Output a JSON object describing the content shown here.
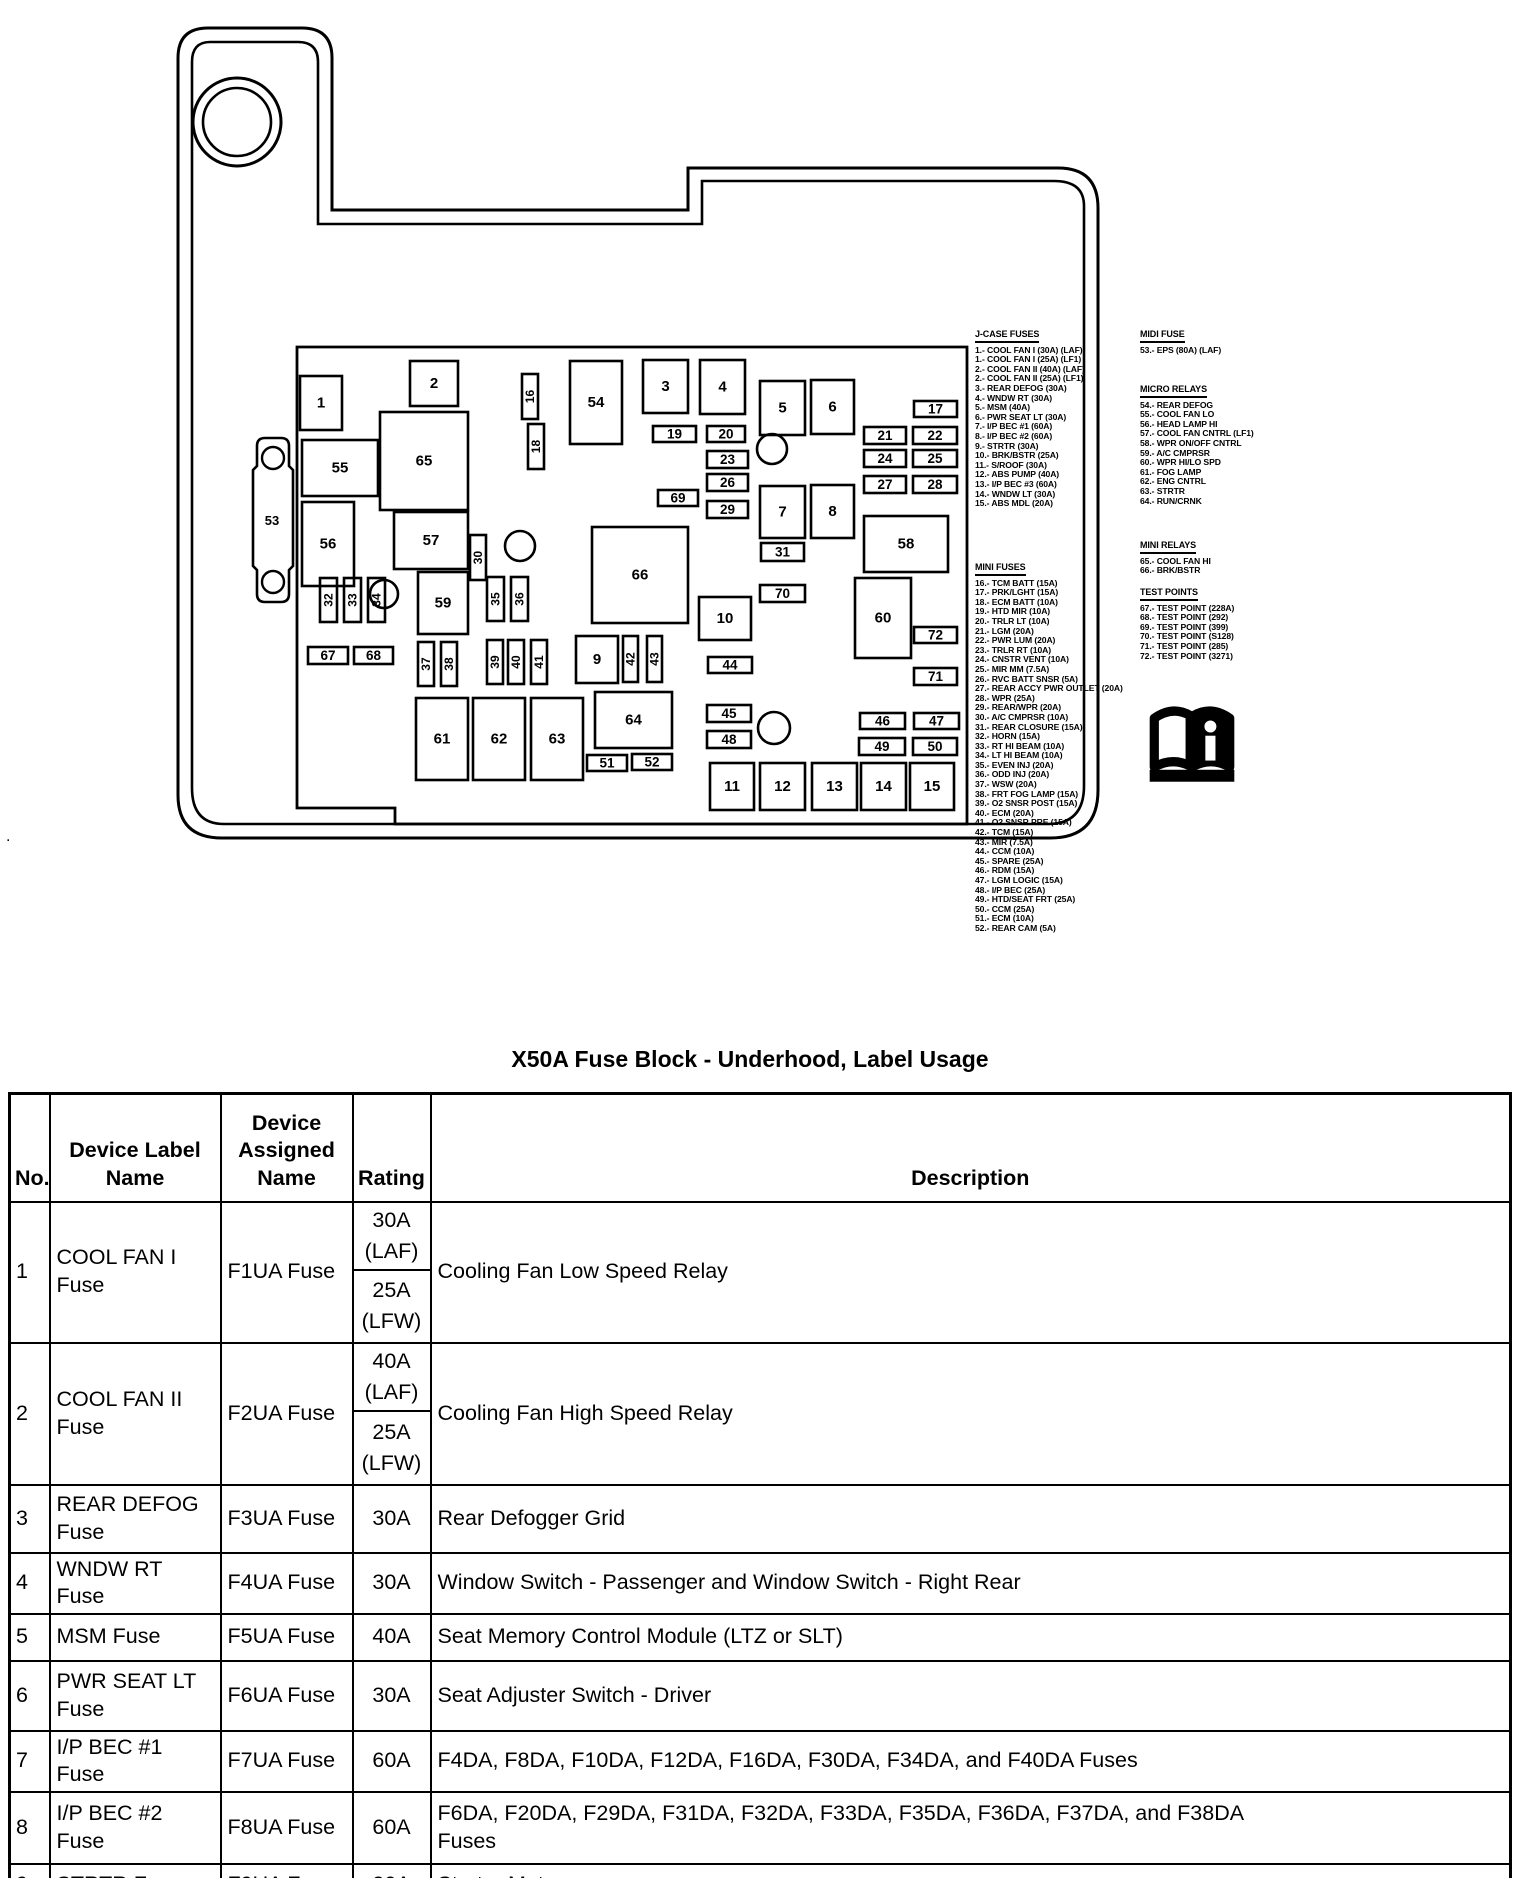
{
  "page": {
    "title": "X50A Fuse Block - Underhood, Label Usage",
    "stray_mark": "."
  },
  "diagram": {
    "bracket": {
      "label": "53",
      "holes": [
        {
          "cx": 273,
          "cy": 458,
          "r": 11
        },
        {
          "cx": 273,
          "cy": 582,
          "r": 11
        }
      ]
    },
    "donut": {
      "cx": 237,
      "cy": 122,
      "r_outer": 44,
      "r_inner": 34
    },
    "circles": [
      {
        "cx": 772,
        "cy": 449,
        "r": 15
      },
      {
        "cx": 520,
        "cy": 546,
        "r": 15
      },
      {
        "cx": 384,
        "cy": 594,
        "r": 14
      },
      {
        "cx": 774,
        "cy": 728,
        "r": 16
      }
    ],
    "boxes": [
      {
        "n": "1",
        "x": 300,
        "y": 376,
        "w": 42,
        "h": 54
      },
      {
        "n": "55",
        "x": 302,
        "y": 440,
        "w": 76,
        "h": 56
      },
      {
        "n": "56",
        "x": 302,
        "y": 502,
        "w": 52,
        "h": 84
      },
      {
        "n": "2",
        "x": 410,
        "y": 361,
        "w": 48,
        "h": 45
      },
      {
        "n": "65",
        "x": 380,
        "y": 412,
        "w": 88,
        "h": 98
      },
      {
        "n": "57",
        "x": 394,
        "y": 512,
        "w": 74,
        "h": 57
      },
      {
        "n": "59",
        "x": 418,
        "y": 572,
        "w": 50,
        "h": 62
      },
      {
        "n": "54",
        "x": 570,
        "y": 361,
        "w": 52,
        "h": 83
      },
      {
        "n": "3",
        "x": 643,
        "y": 360,
        "w": 45,
        "h": 53
      },
      {
        "n": "4",
        "x": 700,
        "y": 360,
        "w": 45,
        "h": 54
      },
      {
        "n": "5",
        "x": 760,
        "y": 381,
        "w": 45,
        "h": 54
      },
      {
        "n": "6",
        "x": 811,
        "y": 380,
        "w": 43,
        "h": 54
      },
      {
        "n": "7",
        "x": 760,
        "y": 486,
        "w": 45,
        "h": 52
      },
      {
        "n": "8",
        "x": 811,
        "y": 485,
        "w": 43,
        "h": 53
      },
      {
        "n": "58",
        "x": 864,
        "y": 516,
        "w": 84,
        "h": 56
      },
      {
        "n": "66",
        "x": 592,
        "y": 527,
        "w": 96,
        "h": 96
      },
      {
        "n": "60",
        "x": 855,
        "y": 578,
        "w": 56,
        "h": 80
      },
      {
        "n": "10",
        "x": 699,
        "y": 597,
        "w": 52,
        "h": 43
      },
      {
        "n": "9",
        "x": 576,
        "y": 636,
        "w": 42,
        "h": 47
      },
      {
        "n": "61",
        "x": 416,
        "y": 698,
        "w": 52,
        "h": 82
      },
      {
        "n": "62",
        "x": 473,
        "y": 698,
        "w": 52,
        "h": 82
      },
      {
        "n": "63",
        "x": 531,
        "y": 698,
        "w": 52,
        "h": 82
      },
      {
        "n": "64",
        "x": 595,
        "y": 692,
        "w": 77,
        "h": 56
      },
      {
        "n": "11",
        "x": 710,
        "y": 763,
        "w": 44,
        "h": 47
      },
      {
        "n": "12",
        "x": 760,
        "y": 763,
        "w": 45,
        "h": 47
      },
      {
        "n": "13",
        "x": 812,
        "y": 763,
        "w": 45,
        "h": 47
      },
      {
        "n": "14",
        "x": 861,
        "y": 763,
        "w": 45,
        "h": 47
      },
      {
        "n": "15",
        "x": 910,
        "y": 763,
        "w": 44,
        "h": 47
      },
      {
        "n": "17",
        "x": 914,
        "y": 401,
        "w": 43,
        "h": 16,
        "s": 1
      },
      {
        "n": "19",
        "x": 653,
        "y": 426,
        "w": 43,
        "h": 16,
        "s": 1
      },
      {
        "n": "20",
        "x": 707,
        "y": 426,
        "w": 38,
        "h": 16,
        "s": 1
      },
      {
        "n": "23",
        "x": 707,
        "y": 451,
        "w": 41,
        "h": 17,
        "s": 1
      },
      {
        "n": "26",
        "x": 707,
        "y": 474,
        "w": 41,
        "h": 17,
        "s": 1
      },
      {
        "n": "69",
        "x": 658,
        "y": 490,
        "w": 40,
        "h": 16,
        "s": 1
      },
      {
        "n": "29",
        "x": 707,
        "y": 501,
        "w": 41,
        "h": 17,
        "s": 1
      },
      {
        "n": "21",
        "x": 864,
        "y": 427,
        "w": 42,
        "h": 17,
        "s": 1
      },
      {
        "n": "22",
        "x": 913,
        "y": 427,
        "w": 44,
        "h": 17,
        "s": 1
      },
      {
        "n": "24",
        "x": 864,
        "y": 450,
        "w": 42,
        "h": 17,
        "s": 1
      },
      {
        "n": "25",
        "x": 913,
        "y": 450,
        "w": 44,
        "h": 17,
        "s": 1
      },
      {
        "n": "27",
        "x": 864,
        "y": 476,
        "w": 42,
        "h": 17,
        "s": 1
      },
      {
        "n": "28",
        "x": 913,
        "y": 476,
        "w": 44,
        "h": 17,
        "s": 1
      },
      {
        "n": "31",
        "x": 761,
        "y": 543,
        "w": 43,
        "h": 18,
        "s": 1
      },
      {
        "n": "70",
        "x": 760,
        "y": 585,
        "w": 45,
        "h": 17,
        "s": 1
      },
      {
        "n": "72",
        "x": 914,
        "y": 627,
        "w": 43,
        "h": 16,
        "s": 1
      },
      {
        "n": "71",
        "x": 914,
        "y": 668,
        "w": 43,
        "h": 17,
        "s": 1
      },
      {
        "n": "44",
        "x": 708,
        "y": 657,
        "w": 44,
        "h": 16,
        "s": 1
      },
      {
        "n": "45",
        "x": 707,
        "y": 705,
        "w": 44,
        "h": 17,
        "s": 1
      },
      {
        "n": "48",
        "x": 707,
        "y": 731,
        "w": 44,
        "h": 17,
        "s": 1
      },
      {
        "n": "46",
        "x": 860,
        "y": 713,
        "w": 45,
        "h": 16,
        "s": 1
      },
      {
        "n": "47",
        "x": 914,
        "y": 713,
        "w": 45,
        "h": 16,
        "s": 1
      },
      {
        "n": "49",
        "x": 859,
        "y": 738,
        "w": 46,
        "h": 17,
        "s": 1
      },
      {
        "n": "50",
        "x": 913,
        "y": 738,
        "w": 44,
        "h": 17,
        "s": 1
      },
      {
        "n": "51",
        "x": 587,
        "y": 755,
        "w": 40,
        "h": 16,
        "s": 1
      },
      {
        "n": "52",
        "x": 632,
        "y": 754,
        "w": 40,
        "h": 16,
        "s": 1
      },
      {
        "n": "67",
        "x": 308,
        "y": 647,
        "w": 40,
        "h": 17,
        "s": 1
      },
      {
        "n": "68",
        "x": 354,
        "y": 647,
        "w": 39,
        "h": 17,
        "s": 1
      },
      {
        "n": "16",
        "x": 522,
        "y": 374,
        "w": 16,
        "h": 45,
        "v": 1
      },
      {
        "n": "18",
        "x": 528,
        "y": 424,
        "w": 16,
        "h": 45,
        "v": 1
      },
      {
        "n": "30",
        "x": 470,
        "y": 535,
        "w": 16,
        "h": 45,
        "v": 1
      },
      {
        "n": "32",
        "x": 320,
        "y": 578,
        "w": 17,
        "h": 44,
        "v": 1
      },
      {
        "n": "33",
        "x": 344,
        "y": 578,
        "w": 17,
        "h": 44,
        "v": 1
      },
      {
        "n": "34",
        "x": 368,
        "y": 578,
        "w": 17,
        "h": 44,
        "v": 1
      },
      {
        "n": "35",
        "x": 487,
        "y": 577,
        "w": 17,
        "h": 44,
        "v": 1
      },
      {
        "n": "36",
        "x": 511,
        "y": 577,
        "w": 17,
        "h": 44,
        "v": 1
      },
      {
        "n": "37",
        "x": 418,
        "y": 642,
        "w": 16,
        "h": 44,
        "v": 1
      },
      {
        "n": "38",
        "x": 441,
        "y": 642,
        "w": 16,
        "h": 44,
        "v": 1
      },
      {
        "n": "39",
        "x": 487,
        "y": 640,
        "w": 16,
        "h": 44,
        "v": 1
      },
      {
        "n": "40",
        "x": 508,
        "y": 640,
        "w": 16,
        "h": 44,
        "v": 1
      },
      {
        "n": "41",
        "x": 531,
        "y": 640,
        "w": 16,
        "h": 44,
        "v": 1
      },
      {
        "n": "42",
        "x": 623,
        "y": 636,
        "w": 15,
        "h": 46,
        "v": 1
      },
      {
        "n": "43",
        "x": 647,
        "y": 636,
        "w": 15,
        "h": 46,
        "v": 1
      }
    ],
    "legend": {
      "col1": [
        {
          "header": "J-CASE FUSES",
          "top": 330,
          "items": [
            "1.- COOL FAN I (30A) (LAF)",
            "1.- COOL FAN I (25A) (LF1)",
            "2.- COOL FAN II (40A) (LAF)",
            "2.- COOL FAN II (25A) (LF1)",
            "3.- REAR DEFOG (30A)",
            "4.- WNDW RT (30A)",
            "5.- MSM (40A)",
            "6.- PWR SEAT LT (30A)",
            "7.- I/P BEC #1 (60A)",
            "8.- I/P BEC #2 (60A)",
            "9.- STRTR (30A)",
            "10.- BRK/BSTR (25A)",
            "11.- S/ROOF (30A)",
            "12.- ABS PUMP (40A)",
            "13.- I/P BEC #3 (60A)",
            "14.- WNDW LT (30A)",
            "15.- ABS MDL (20A)"
          ]
        },
        {
          "header": "MINI FUSES",
          "top": 563,
          "items": [
            "16.- TCM BATT (15A)",
            "17.- PRK/LGHT (15A)",
            "18.- ECM BATT (10A)",
            "19.- HTD MIR (10A)",
            "20.- TRLR LT (10A)",
            "21.- LGM (20A)",
            "22.- PWR LUM (20A)",
            "23.- TRLR RT (10A)",
            "24.- CNSTR VENT (10A)",
            "25.- MIR MM (7.5A)",
            "26.- RVC BATT SNSR (5A)",
            "27.- REAR ACCY PWR OUTLET (20A)",
            "28.- WPR (25A)",
            "29.- REAR/WPR (20A)",
            "30.- A/C CMPRSR (10A)",
            "31.- REAR CLOSURE (15A)",
            "32.- HORN (15A)",
            "33.- RT HI BEAM (10A)",
            "34.- LT HI BEAM (10A)",
            "35.- EVEN INJ (20A)",
            "36.- ODD INJ (20A)",
            "37.- WSW (20A)",
            "38.- FRT FOG LAMP (15A)",
            "39.- O2 SNSR POST (15A)",
            "40.- ECM (20A)",
            "41.- O2 SNSR PRE (15A)",
            "42.- TCM (15A)",
            "43.- MIR (7.5A)",
            "44.- CCM (10A)",
            "45.- SPARE (25A)",
            "46.- RDM (15A)",
            "47.- LGM LOGIC (15A)",
            "48.- I/P BEC (25A)",
            "49.- HTD/SEAT FRT (25A)",
            "50.- CCM (25A)",
            "51.- ECM (10A)",
            "52.- REAR CAM (5A)"
          ]
        }
      ],
      "col2": [
        {
          "header": "MIDI FUSE",
          "top": 330,
          "items": [
            "53.- EPS (80A) (LAF)"
          ]
        },
        {
          "header": "MICRO RELAYS",
          "top": 385,
          "items": [
            "54.- REAR DEFOG",
            "55.- COOL FAN LO",
            "56.- HEAD LAMP HI",
            "57.- COOL FAN CNTRL (LF1)",
            "58.- WPR ON/OFF CNTRL",
            "59.- A/C CMPRSR",
            "60.- WPR HI/LO SPD",
            "61.- FOG LAMP",
            "62.- ENG CNTRL",
            "63.- STRTR",
            "64.- RUN/CRNK"
          ]
        },
        {
          "header": "MINI RELAYS",
          "top": 541,
          "items": [
            "65.- COOL FAN HI",
            "66.- BRK/BSTR"
          ]
        },
        {
          "header": "TEST POINTS",
          "top": 588,
          "items": [
            "67.- TEST POINT (228A)",
            "68.- TEST POINT (292)",
            "69.- TEST POINT (399)",
            "70.- TEST POINT (S128)",
            "71.- TEST POINT (285)",
            "72.- TEST POINT (3271)"
          ]
        }
      ]
    },
    "book_icon": "owner-manual-info-icon"
  },
  "table": {
    "headers": [
      "No.",
      "Device Label Name",
      "Device Assigned Name",
      "Rating",
      "Description"
    ],
    "rows": [
      {
        "no": "1",
        "label": "COOL FAN I\nFuse",
        "assigned": "F1UA Fuse",
        "rating": [
          "30A (LAF)",
          "25A (LFW)"
        ],
        "desc": "Cooling Fan Low Speed Relay"
      },
      {
        "no": "2",
        "label": "COOL FAN II\nFuse",
        "assigned": "F2UA Fuse",
        "rating": [
          "40A (LAF)",
          "25A (LFW)"
        ],
        "desc": "Cooling Fan High Speed Relay"
      },
      {
        "no": "3",
        "label": "REAR DEFOG\nFuse",
        "assigned": "F3UA Fuse",
        "rating": [
          "30A"
        ],
        "desc": "Rear Defogger Grid"
      },
      {
        "no": "4",
        "label": "WNDW RT Fuse",
        "assigned": "F4UA Fuse",
        "rating": [
          "30A"
        ],
        "desc": "Window Switch - Passenger and Window Switch - Right Rear"
      },
      {
        "no": "5",
        "label": "MSM Fuse",
        "assigned": "F5UA Fuse",
        "rating": [
          "40A"
        ],
        "desc": "Seat Memory Control Module (LTZ or SLT)"
      },
      {
        "no": "6",
        "label": "PWR SEAT LT\nFuse",
        "assigned": "F6UA Fuse",
        "rating": [
          "30A"
        ],
        "desc": "Seat Adjuster Switch - Driver"
      },
      {
        "no": "7",
        "label": "I/P BEC #1 Fuse",
        "assigned": "F7UA Fuse",
        "rating": [
          "60A"
        ],
        "desc": "F4DA, F8DA, F10DA, F12DA, F16DA, F30DA, F34DA, and F40DA Fuses"
      },
      {
        "no": "8",
        "label": "I/P BEC #2 Fuse",
        "assigned": "F8UA Fuse",
        "rating": [
          "60A"
        ],
        "desc": "F6DA, F20DA, F29DA, F31DA, F32DA, F33DA, F35DA, F36DA, F37DA, and F38DA\nFuses"
      },
      {
        "no": "9",
        "label": "STRTR Fuse",
        "assigned": "F9UA Fuse",
        "rating": [
          "30A"
        ],
        "desc": "Starter Motor"
      }
    ]
  }
}
